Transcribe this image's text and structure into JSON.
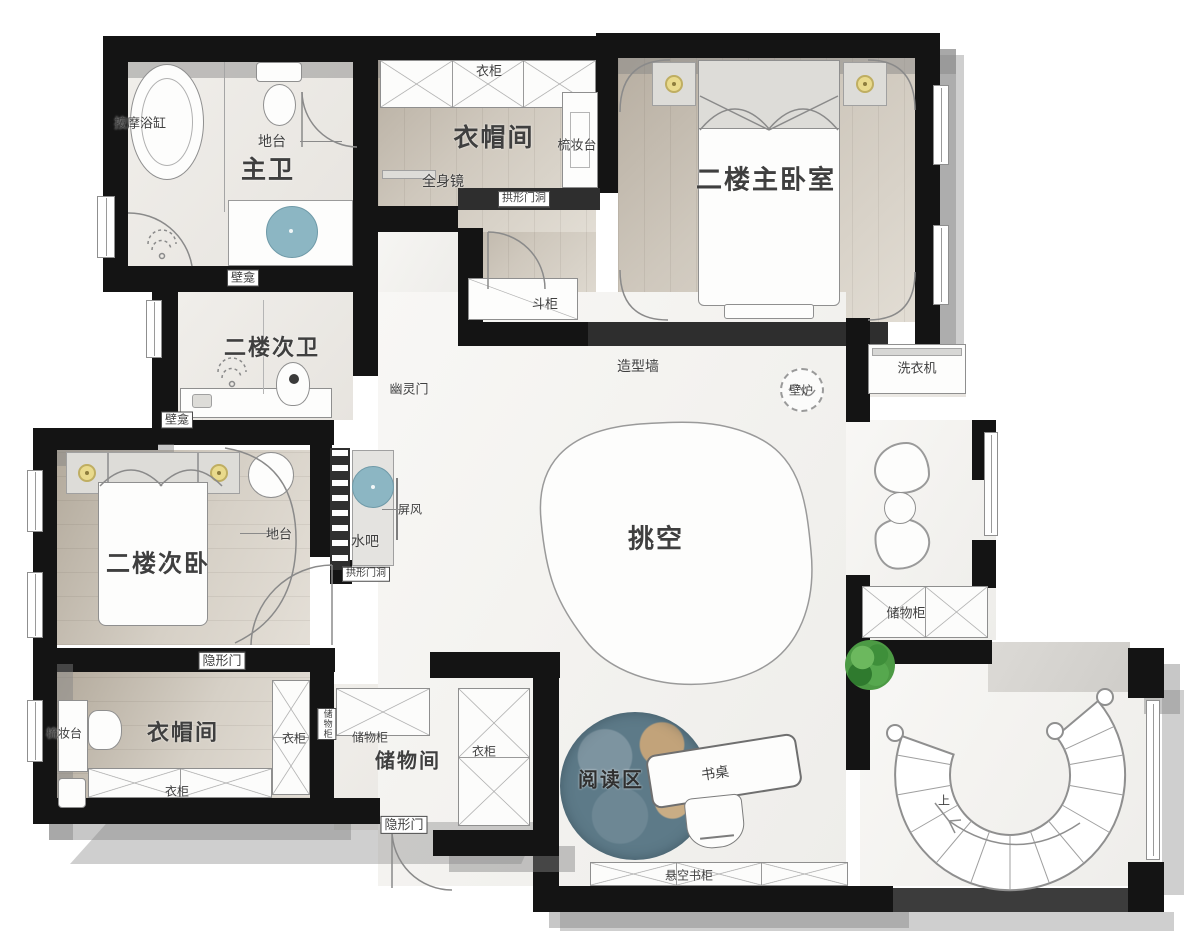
{
  "plan_type": "residential-second-floor-plan",
  "labels": {
    "massage_tub": "按摩浴缸",
    "master_bath_platform": "地台",
    "master_bath": "主卫",
    "master_bath_niche": "壁龛",
    "wardrobe": "衣柜",
    "cloakroom": "衣帽间",
    "dressing_table": "梳妆台",
    "full_length_mirror": "全身镜",
    "arched_opening": "拱形门洞",
    "master_bedroom": "二楼主卧室",
    "chest_of_drawers": "斗柜",
    "feature_wall": "造型墙",
    "fireplace": "壁炉",
    "washing_machine": "洗衣机",
    "second_bath": "二楼次卫",
    "second_bath_niche": "壁龛",
    "ghost_door": "幽灵门",
    "second_bedroom": "二楼次卧",
    "second_bedroom_platform": "地台",
    "water_bar": "水吧",
    "screen_divider": "屏风",
    "water_bar_arched_opening": "拱形门洞",
    "void_space": "挑空",
    "storage_cabinet": "储物柜",
    "hidden_door": "隐形门",
    "dressing_table_2": "梳妆台",
    "cloakroom_2": "衣帽间",
    "wardrobe_2": "衣柜",
    "wardrobe_3": "衣柜",
    "storage_cabinet_2": "储物柜",
    "storage_cabinet_3": "储物柜",
    "storage_room": "储物间",
    "wardrobe_4": "衣柜",
    "hidden_door_2": "隐形门",
    "reading_area": "阅读区",
    "desk": "书桌",
    "floating_bookcase": "悬空书柜",
    "stairs_up": "上"
  },
  "palette": {
    "wall_black": "#141414",
    "feature_wall_dark": "#2e2e2e",
    "wood_dark": "#b3aa9c",
    "wood_light": "#e2ddd4",
    "marble": "#f6f5f3",
    "accent_blue": "#8cb6c3",
    "lamp_yellow": "#e9da8c",
    "plant_green": "#4c9a44",
    "planet_blue": "#5d7a88",
    "planet_tan": "#c2a37a",
    "shadow_gray": "#c3c3c3",
    "label_gray": "#3f3f3f"
  }
}
